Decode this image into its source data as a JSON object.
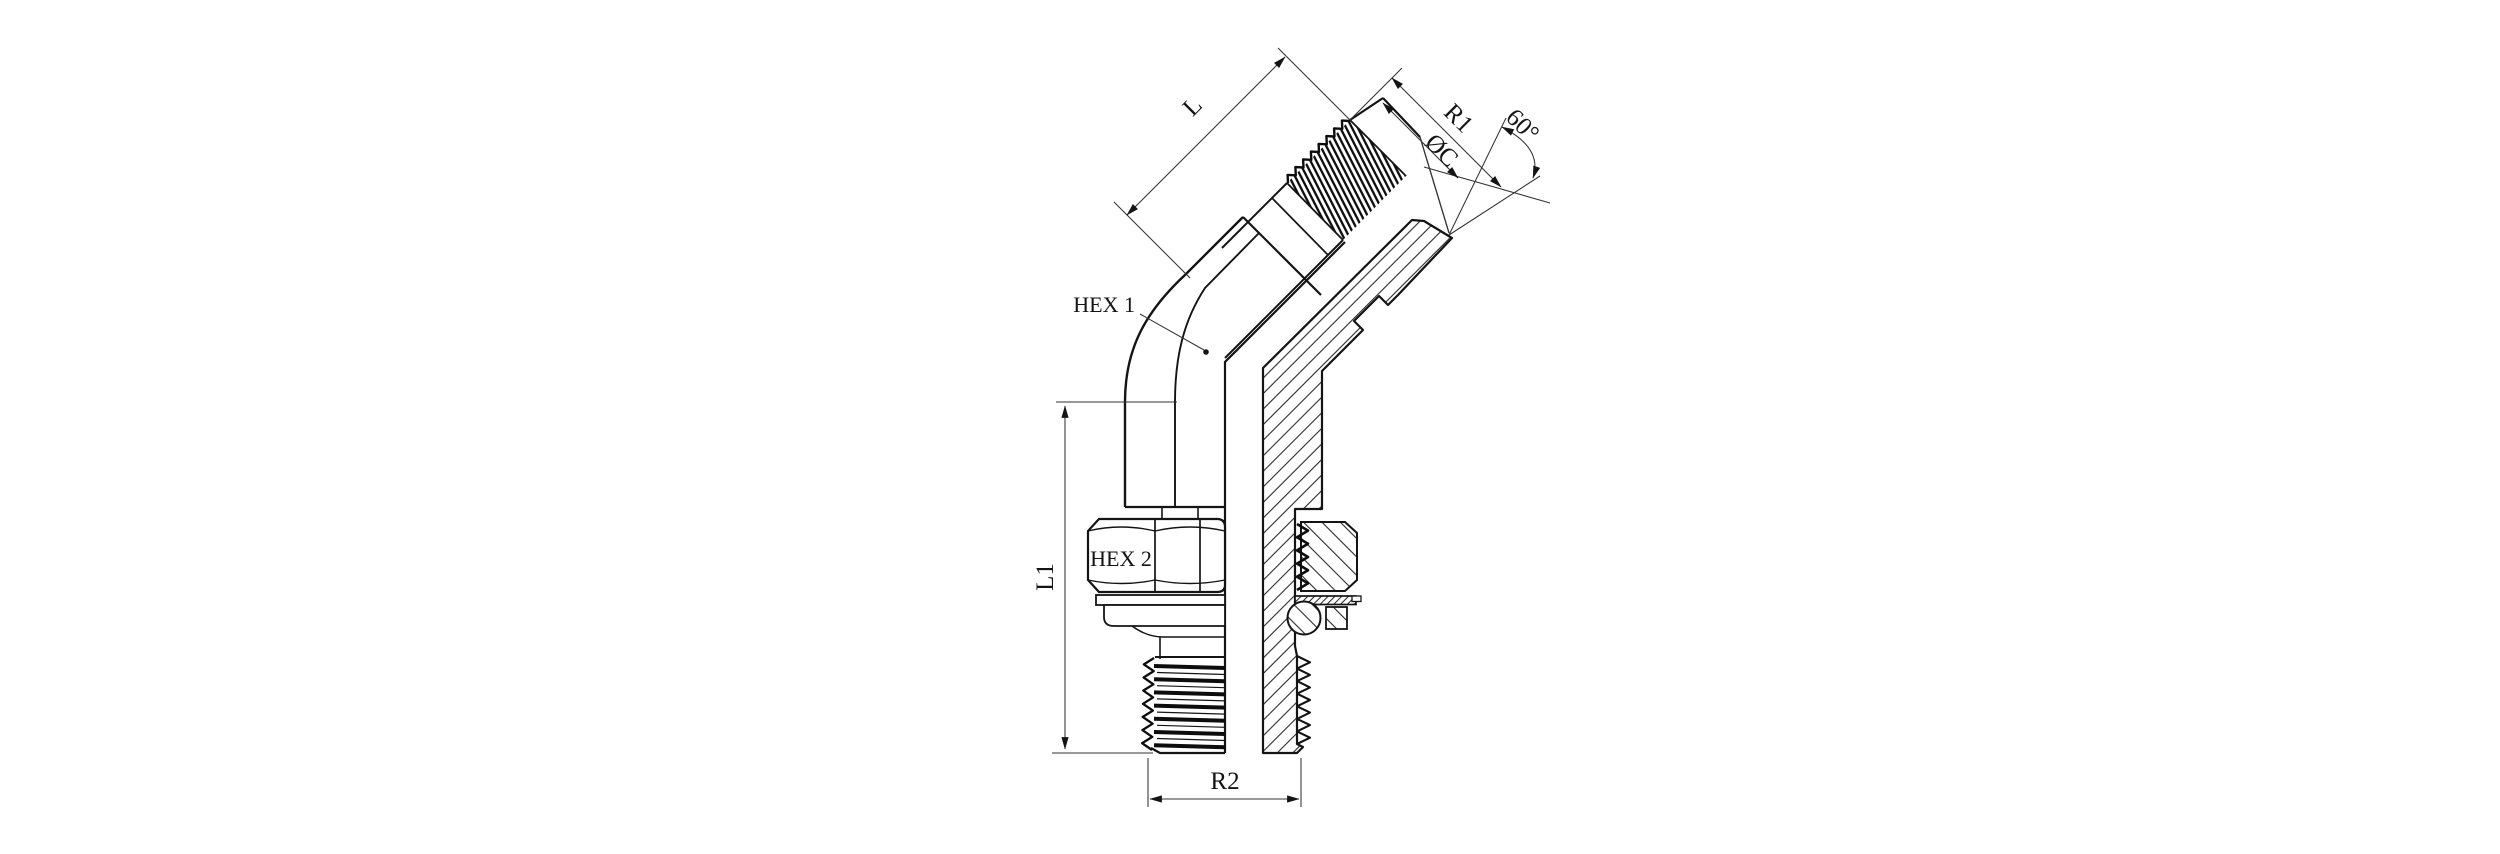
{
  "figure": {
    "background": "#ffffff",
    "line_color": "#141414",
    "thin_line_color": "#333333"
  },
  "labels": {
    "l": "L",
    "r1": "R1",
    "oc": "ØC",
    "angle": "60°",
    "hex1": "HEX 1",
    "hex2": "HEX 2",
    "l1": "L1",
    "r2": "R2"
  }
}
